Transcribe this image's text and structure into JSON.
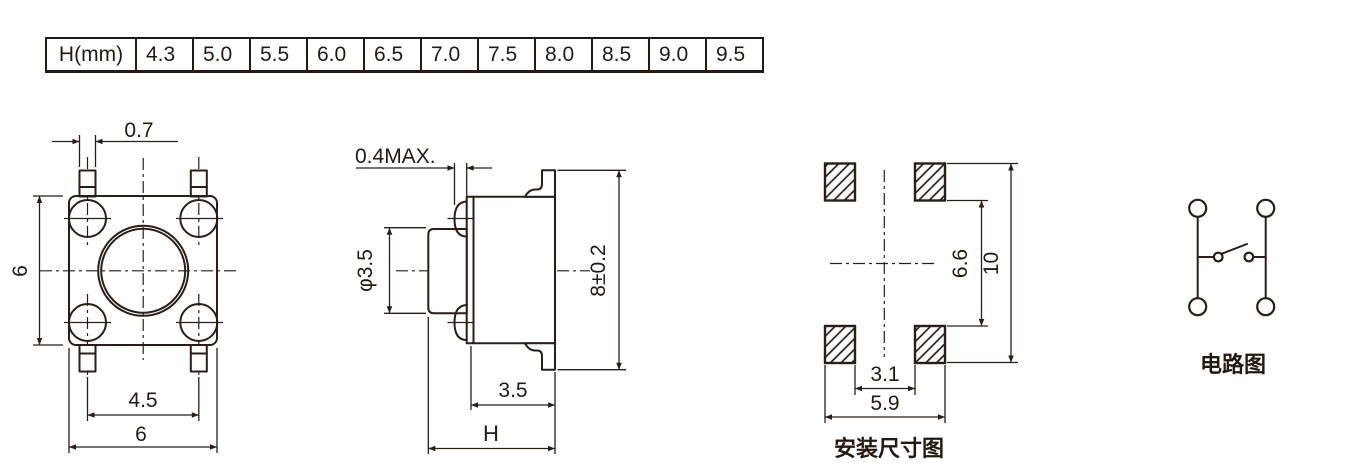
{
  "table": {
    "header": "H(mm)",
    "heights": [
      "4.3",
      "5.0",
      "5.5",
      "6.0",
      "6.5",
      "7.0",
      "7.5",
      "8.0",
      "8.5",
      "9.0",
      "9.5"
    ]
  },
  "top_view": {
    "dim_pin_width": "0.7",
    "dim_body_side": "6",
    "dim_pin_pitch": "4.5",
    "dim_body_width": "6"
  },
  "side_view": {
    "dim_dome_max": "0.4MAX.",
    "dim_stem_dia": "φ3.5",
    "dim_body_depth": "8±0.2",
    "dim_base": "3.5",
    "dim_height": "H"
  },
  "mounting_view": {
    "caption": "安装尺寸图",
    "dim_inner_vertical": "6.6",
    "dim_outer_vertical": "10",
    "dim_inner_horizontal": "3.1",
    "dim_outer_horizontal": "5.9"
  },
  "circuit_view": {
    "caption": "电路图"
  },
  "colors": {
    "line": "#2b1e16",
    "background": "#ffffff"
  }
}
